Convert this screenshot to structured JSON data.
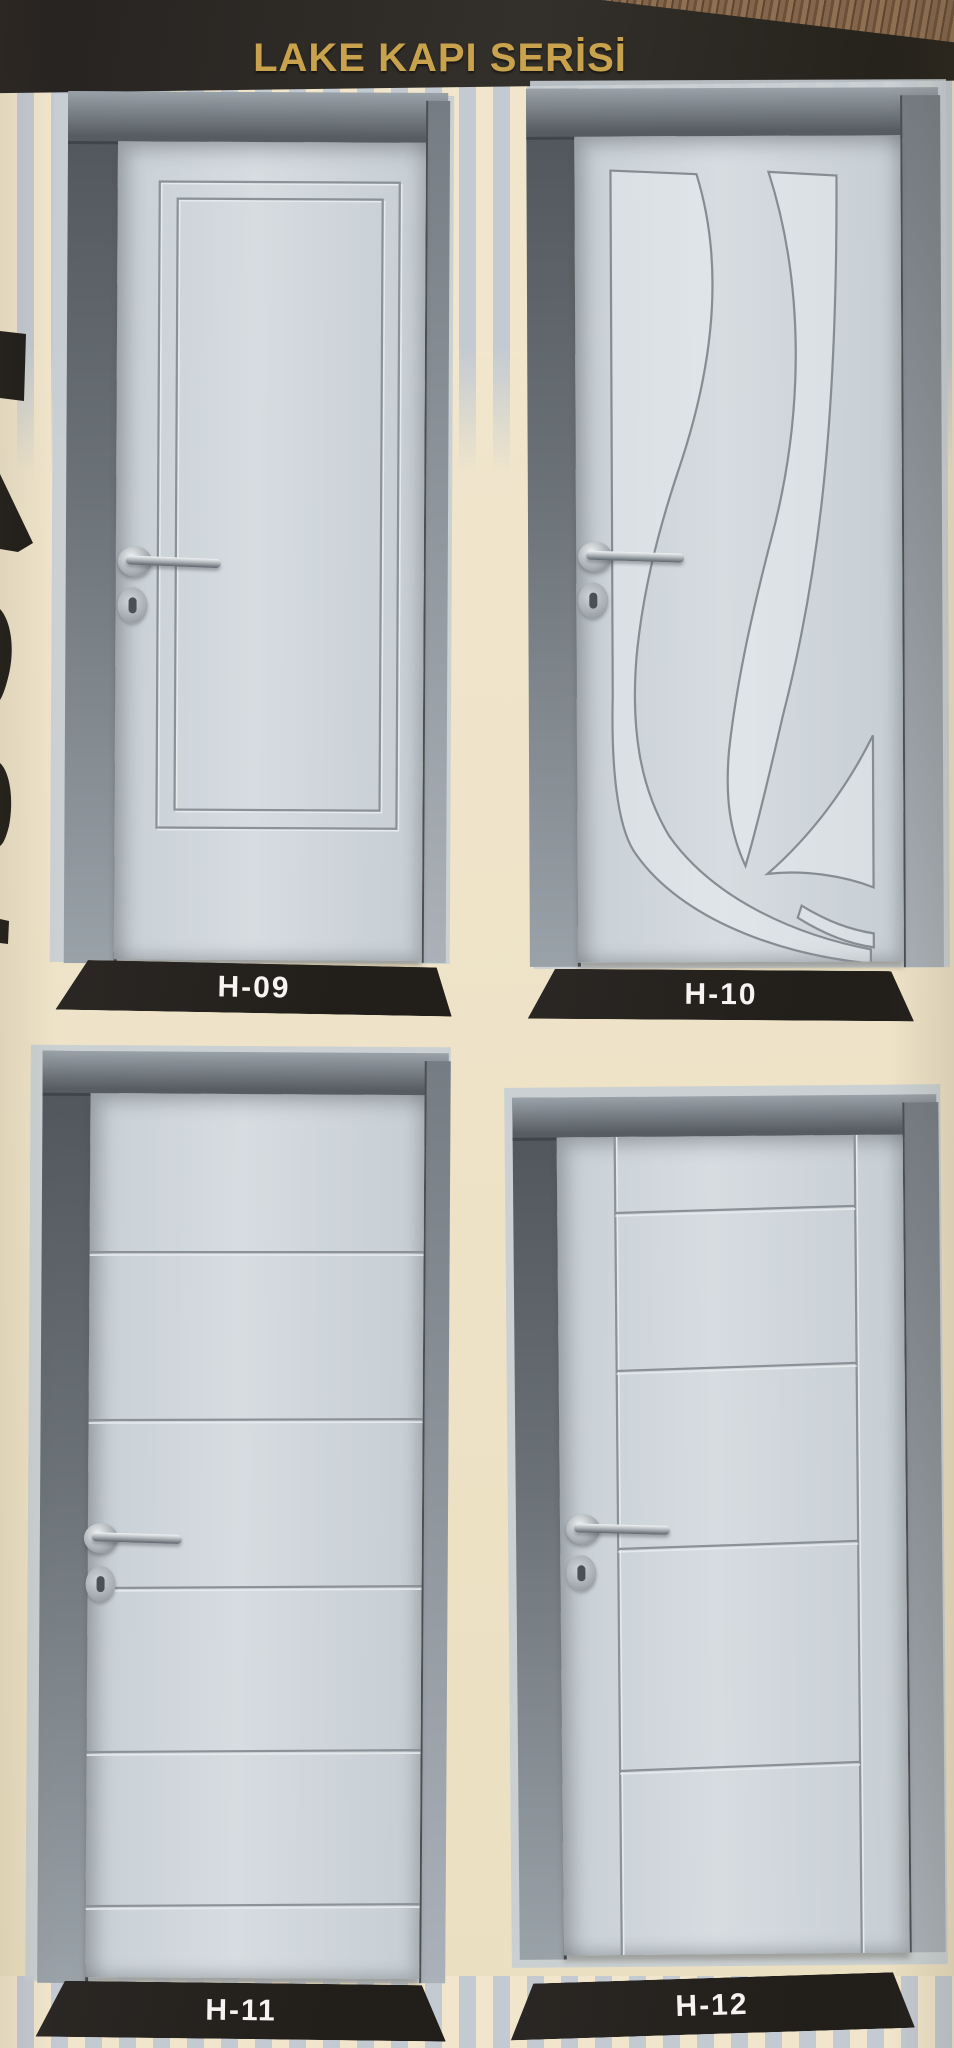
{
  "header": {
    "title": "LAKE KAPI SERİSİ"
  },
  "doors": [
    {
      "id": "H-09",
      "label": "H-09",
      "design": "nested-rectangle-grooves"
    },
    {
      "id": "H-10",
      "label": "H-10",
      "design": "flame-wave-grooves"
    },
    {
      "id": "H-11",
      "label": "H-11",
      "design": "horizontal-panel-grooves"
    },
    {
      "id": "H-12",
      "label": "H-12",
      "design": "vertical-and-horizontal-panel-grooves"
    }
  ],
  "colors": {
    "page_background": "#efe4c9",
    "stripe_blue": "#c3cad1",
    "stripe_cream": "#f1e6cb",
    "header_bar": "#26221e",
    "title_gold": "#c8a24c",
    "label_background": "#27231f",
    "label_text": "#f5f4f2",
    "door_leaf": "#ccd3d8",
    "door_frame_dark": "#565c62",
    "door_frame_light": "#9aa2a9",
    "groove_line": "#8a9197",
    "wood_texture": "#7a5e44",
    "handle_metal": "#a8adb1"
  }
}
